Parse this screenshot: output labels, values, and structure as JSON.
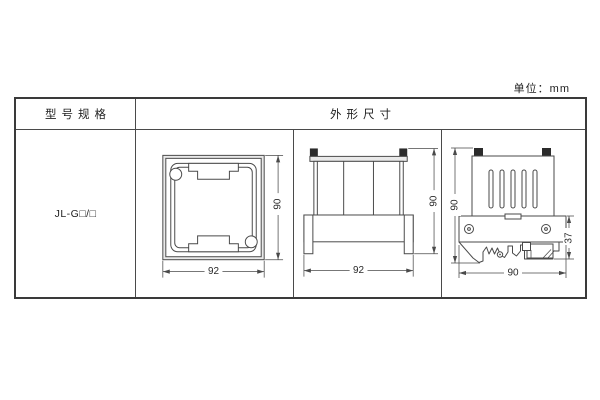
{
  "unit_label": "单位：mm",
  "table": {
    "col_model_header": "型号规格",
    "col_dims_header": "外形尺寸",
    "model_value": "JL-G□/□"
  },
  "drawings": {
    "front_view": {
      "width": "92",
      "height": "90"
    },
    "side_view": {
      "width": "92",
      "height": "90"
    },
    "rail_view": {
      "height": "90",
      "depth": "37",
      "width": "90"
    }
  }
}
